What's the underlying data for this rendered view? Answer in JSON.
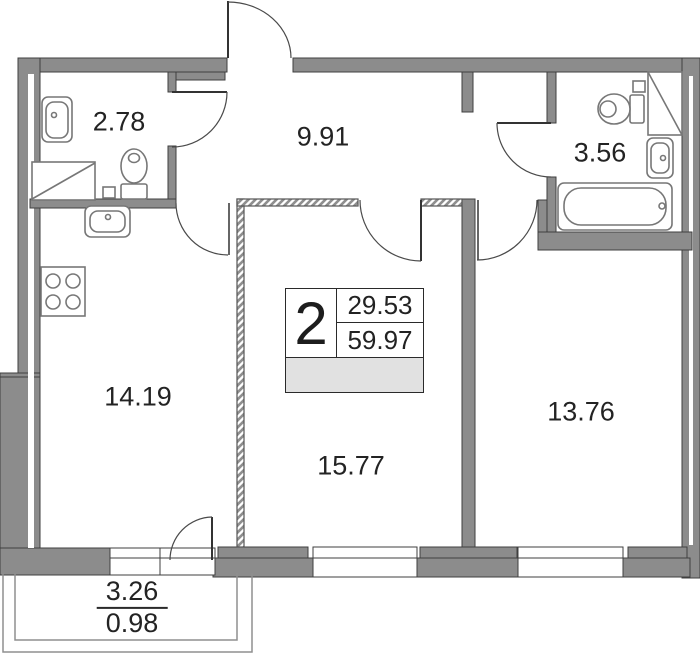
{
  "floor_plan": {
    "info_box": {
      "room_count": "2",
      "area_top": "29.53",
      "area_bottom": "59.97"
    },
    "rooms": [
      {
        "id": "bathroom-small",
        "area": "2.78"
      },
      {
        "id": "hallway",
        "area": "9.91"
      },
      {
        "id": "bathroom-large",
        "area": "3.56"
      },
      {
        "id": "kitchen",
        "area": "14.19"
      },
      {
        "id": "living-room",
        "area": "15.77"
      },
      {
        "id": "bedroom",
        "area": "13.76"
      }
    ],
    "balcony": {
      "area_top": "3.26",
      "area_bottom": "0.98"
    },
    "fixtures": [
      "sink-icon",
      "toilet-icon",
      "washing-machine-icon",
      "stove-icon",
      "kitchen-sink-icon",
      "bathtub-icon",
      "door-arc-icon",
      "window-icon"
    ],
    "colors": {
      "wall": "#8c8c8c",
      "wall_outline": "#3f3f3f",
      "hatch_stripe": "#8f8f8f",
      "fixture_outline": "#777777",
      "door_arc": "#4a4a4a",
      "info_bar_fill": "#e1e1e1",
      "text": "#232323",
      "background": "#ffffff"
    }
  }
}
